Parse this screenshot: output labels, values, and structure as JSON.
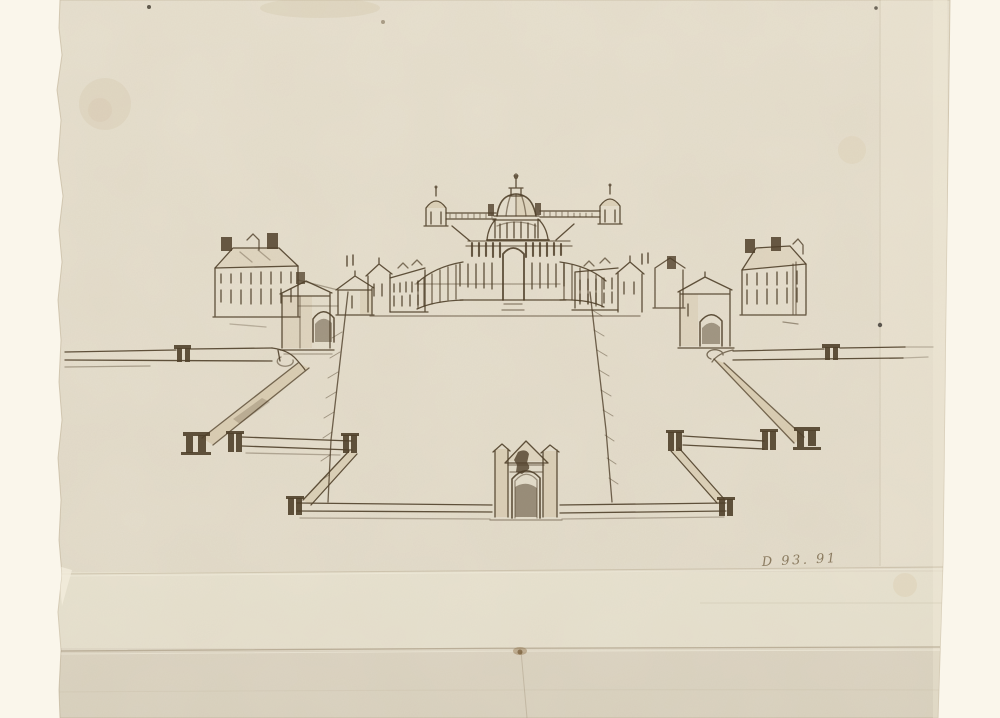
{
  "artwork": {
    "inscription": "D 93. 91",
    "colors": {
      "background": "#faf6eb",
      "paper": "#e8e1d0",
      "ink": "#50402a",
      "wash": "#c7b28c",
      "inscription_ink": "#8b7b60"
    }
  }
}
